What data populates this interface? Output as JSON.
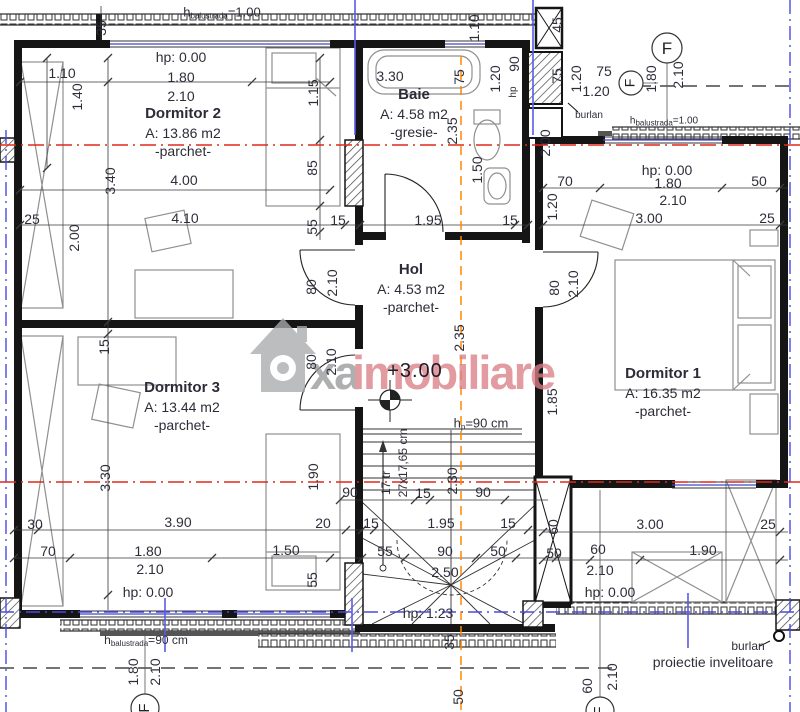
{
  "watermark": {
    "gray_text": "xa",
    "red_text": "imobiliare"
  },
  "grid_marker": "F",
  "colors": {
    "section_line_red": "#e02818",
    "axis_line_blue": "#4a4ae0",
    "center_line_orange": "#ff8800",
    "watermark_red": "#db7f86",
    "watermark_gray": "#98999b",
    "wall_black": "#151515"
  },
  "rooms": {
    "dormitor2": {
      "name": "Dormitor 2",
      "area": "A: 13.86 m2",
      "finish": "-parchet-"
    },
    "baie": {
      "name": "Baie",
      "area": "A: 4.58 m2",
      "finish": "-gresie-"
    },
    "hol": {
      "name": "Hol",
      "area": "A: 4.53 m2",
      "finish": "-parchet-"
    },
    "dormitor1": {
      "name": "Dormitor 1",
      "area": "A: 16.35 m2",
      "finish": "-parchet-"
    },
    "dormitor3": {
      "name": "Dormitor 3",
      "area": "A: 13.44 m2",
      "finish": "-parchet-"
    }
  },
  "notes": {
    "balustrade_top": {
      "prefix": "h",
      "sub": "balustrada",
      "value": "=1.00"
    },
    "balustrade_top_right": {
      "prefix": "h",
      "sub": "balustrada",
      "value": "=1.00"
    },
    "balustrade_bottom": {
      "prefix": "h",
      "sub": "balustrada",
      "value": "=90 cm"
    },
    "stair_parapet": {
      "prefix": "h",
      "sub": "p",
      "value": "=90 cm"
    },
    "level": "+3.00",
    "burlan": "burlan",
    "roof_projection": "proiectie invelitoare",
    "stair_treads": "17 tr",
    "stair_step_size": "27x17,65 cm"
  },
  "dim_labels": [
    {
      "t": "35",
      "x": 101,
      "y": 28,
      "r": 1
    },
    {
      "t": "hp: 0.00",
      "x": 181,
      "y": 57
    },
    {
      "t": "1.10",
      "x": 62,
      "y": 73
    },
    {
      "t": "1.80",
      "x": 181,
      "y": 77
    },
    {
      "t": "2.10",
      "x": 181,
      "y": 96
    },
    {
      "t": "1.40",
      "x": 77,
      "y": 97,
      "r": 1
    },
    {
      "t": "1.15",
      "x": 313,
      "y": 93,
      "r": 1
    },
    {
      "t": "3.40",
      "x": 110,
      "y": 181,
      "r": 1
    },
    {
      "t": "4.00",
      "x": 184,
      "y": 180
    },
    {
      "t": "85",
      "x": 312,
      "y": 168,
      "r": 1
    },
    {
      "t": "25",
      "x": 32,
      "y": 219
    },
    {
      "t": "4.10",
      "x": 185,
      "y": 218
    },
    {
      "t": "15",
      "x": 338,
      "y": 220
    },
    {
      "t": "55",
      "x": 312,
      "y": 227,
      "r": 1
    },
    {
      "t": "2.00",
      "x": 74,
      "y": 238,
      "r": 1
    },
    {
      "t": "15",
      "x": 104,
      "y": 347,
      "r": 1
    },
    {
      "t": "3.30",
      "x": 390,
      "y": 76
    },
    {
      "t": "75",
      "x": 459,
      "y": 77,
      "r": 1
    },
    {
      "t": "1.10",
      "x": 474,
      "y": 28,
      "r": 1
    },
    {
      "t": "1.20",
      "x": 495,
      "y": 79,
      "r": 1
    },
    {
      "t": "90",
      "x": 514,
      "y": 64,
      "r": 1
    },
    {
      "t": "hp",
      "x": 514,
      "y": 92,
      "r": 1,
      "s": 1
    },
    {
      "t": "2.35",
      "x": 452,
      "y": 131,
      "r": 1
    },
    {
      "t": "1.50",
      "x": 477,
      "y": 170,
      "r": 1
    },
    {
      "t": "1.95",
      "x": 428,
      "y": 220
    },
    {
      "t": "15",
      "x": 510,
      "y": 220
    },
    {
      "t": "45",
      "x": 557,
      "y": 25,
      "r": 1
    },
    {
      "t": "75",
      "x": 557,
      "y": 76,
      "r": 1
    },
    {
      "t": "1.20",
      "x": 576,
      "y": 79,
      "r": 1
    },
    {
      "t": "75",
      "x": 604,
      "y": 71
    },
    {
      "t": "1.20",
      "x": 596,
      "y": 91
    },
    {
      "t": "1.80",
      "x": 651,
      "y": 79,
      "r": 1
    },
    {
      "t": "2.10",
      "x": 678,
      "y": 75,
      "r": 1
    },
    {
      "t": "2.00",
      "x": 545,
      "y": 143,
      "r": 1
    },
    {
      "t": "1.20",
      "x": 552,
      "y": 207,
      "r": 1
    },
    {
      "t": "70",
      "x": 565,
      "y": 181
    },
    {
      "t": "hp: 0.00",
      "x": 667,
      "y": 170
    },
    {
      "t": "1.80",
      "x": 668,
      "y": 183
    },
    {
      "t": "50",
      "x": 759,
      "y": 181
    },
    {
      "t": "2.10",
      "x": 673,
      "y": 200
    },
    {
      "t": "3.00",
      "x": 649,
      "y": 218
    },
    {
      "t": "25",
      "x": 767,
      "y": 218
    },
    {
      "t": "80",
      "x": 311,
      "y": 287,
      "r": 1
    },
    {
      "t": "2.10",
      "x": 332,
      "y": 283,
      "r": 1
    },
    {
      "t": "80",
      "x": 311,
      "y": 362,
      "r": 1
    },
    {
      "t": "2.10",
      "x": 331,
      "y": 362,
      "r": 1
    },
    {
      "t": "80",
      "x": 554,
      "y": 288,
      "r": 1
    },
    {
      "t": "2.10",
      "x": 573,
      "y": 284,
      "r": 1
    },
    {
      "t": "2.35",
      "x": 459,
      "y": 338,
      "r": 1
    },
    {
      "t": "1.85",
      "x": 552,
      "y": 402,
      "r": 1
    },
    {
      "t": "3.00",
      "x": 650,
      "y": 524
    },
    {
      "t": "25",
      "x": 768,
      "y": 524
    },
    {
      "t": "60",
      "x": 553,
      "y": 527,
      "r": 1
    },
    {
      "t": "50",
      "x": 554,
      "y": 553
    },
    {
      "t": "60",
      "x": 598,
      "y": 549
    },
    {
      "t": "1.90",
      "x": 703,
      "y": 550
    },
    {
      "t": "2.10",
      "x": 600,
      "y": 570
    },
    {
      "t": "hp: 0.00",
      "x": 610,
      "y": 592
    },
    {
      "t": "60",
      "x": 587,
      "y": 686,
      "r": 1
    },
    {
      "t": "2.10",
      "x": 612,
      "y": 677,
      "r": 1
    },
    {
      "t": "3.30",
      "x": 105,
      "y": 478,
      "r": 1
    },
    {
      "t": "1.90",
      "x": 313,
      "y": 477,
      "r": 1
    },
    {
      "t": "30",
      "x": 35,
      "y": 524
    },
    {
      "t": "3.90",
      "x": 178,
      "y": 522
    },
    {
      "t": "20",
      "x": 323,
      "y": 523
    },
    {
      "t": "70",
      "x": 48,
      "y": 551
    },
    {
      "t": "1.80",
      "x": 148,
      "y": 551
    },
    {
      "t": "1.50",
      "x": 286,
      "y": 550
    },
    {
      "t": "2.10",
      "x": 150,
      "y": 569
    },
    {
      "t": "55",
      "x": 312,
      "y": 580,
      "r": 1
    },
    {
      "t": "hp: 0.00",
      "x": 148,
      "y": 592
    },
    {
      "t": "1.80",
      "x": 133,
      "y": 672,
      "r": 1
    },
    {
      "t": "2.10",
      "x": 155,
      "y": 672,
      "r": 1
    },
    {
      "t": "90",
      "x": 350,
      "y": 492
    },
    {
      "t": "15",
      "x": 423,
      "y": 493
    },
    {
      "t": "90",
      "x": 483,
      "y": 492
    },
    {
      "t": "2.30",
      "x": 452,
      "y": 481,
      "r": 1
    },
    {
      "t": "15",
      "x": 371,
      "y": 523
    },
    {
      "t": "1.95",
      "x": 441,
      "y": 523
    },
    {
      "t": "15",
      "x": 508,
      "y": 523
    },
    {
      "t": "55",
      "x": 385,
      "y": 551
    },
    {
      "t": "90",
      "x": 445,
      "y": 551
    },
    {
      "t": "50",
      "x": 498,
      "y": 551
    },
    {
      "t": "2.50",
      "x": 445,
      "y": 572
    },
    {
      "t": "hp: 1.23",
      "x": 428,
      "y": 613
    },
    {
      "t": "35",
      "x": 449,
      "y": 642,
      "r": 1
    },
    {
      "t": "50",
      "x": 458,
      "y": 697,
      "r": 1
    }
  ]
}
